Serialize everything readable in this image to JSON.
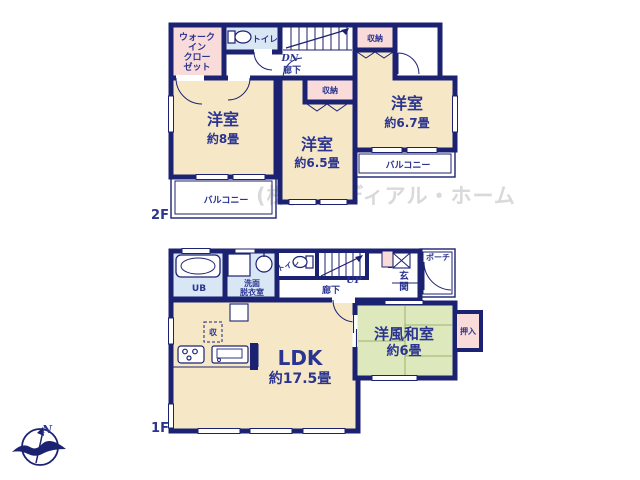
{
  "watermark": "(株)アイディアル・ホーム",
  "compass": {
    "north_label": "N"
  },
  "floor2": {
    "floor_label": "2F",
    "wic_line1": "ウォーク",
    "wic_line2": "イン",
    "wic_line3": "クロー",
    "wic_line4": "ゼット",
    "toilet_label": "トイレ",
    "stairs_down": "DN",
    "hallway_label": "廊下",
    "closet_top": "収納",
    "closet_mid": "収納",
    "room_left_name": "洋室",
    "room_left_size": "約8畳",
    "room_mid_name": "洋室",
    "room_mid_size": "約6.5畳",
    "room_right_name": "洋室",
    "room_right_size": "約6.7畳",
    "balcony_left_label": "バルコニー",
    "balcony_right_label": "バルコニー"
  },
  "floor1": {
    "floor_label": "1F",
    "bath_label": "UB",
    "washroom_line1": "洗面",
    "washroom_line2": "脱衣室",
    "toilet_label": "トイレ",
    "stairs_up": "UP",
    "hallway_label": "廊下",
    "entrance_char1": "玄",
    "entrance_char2": "関",
    "porch_label": "ポーチ",
    "ldk_name": "LDK",
    "ldk_size": "約17.5畳",
    "washitsu_name": "洋風和室",
    "washitsu_size": "約6畳",
    "oshiire_label": "押入",
    "storage_label": "収"
  },
  "colors": {
    "wall": "#1c2272",
    "text": "#2b3490",
    "room_cream": "#f6e8c6",
    "closet_pink": "#f9dcda",
    "water_blue": "#d9e7f5",
    "tatami_green": "#dde9bc",
    "watermark_gray": "#d9d9d9"
  }
}
